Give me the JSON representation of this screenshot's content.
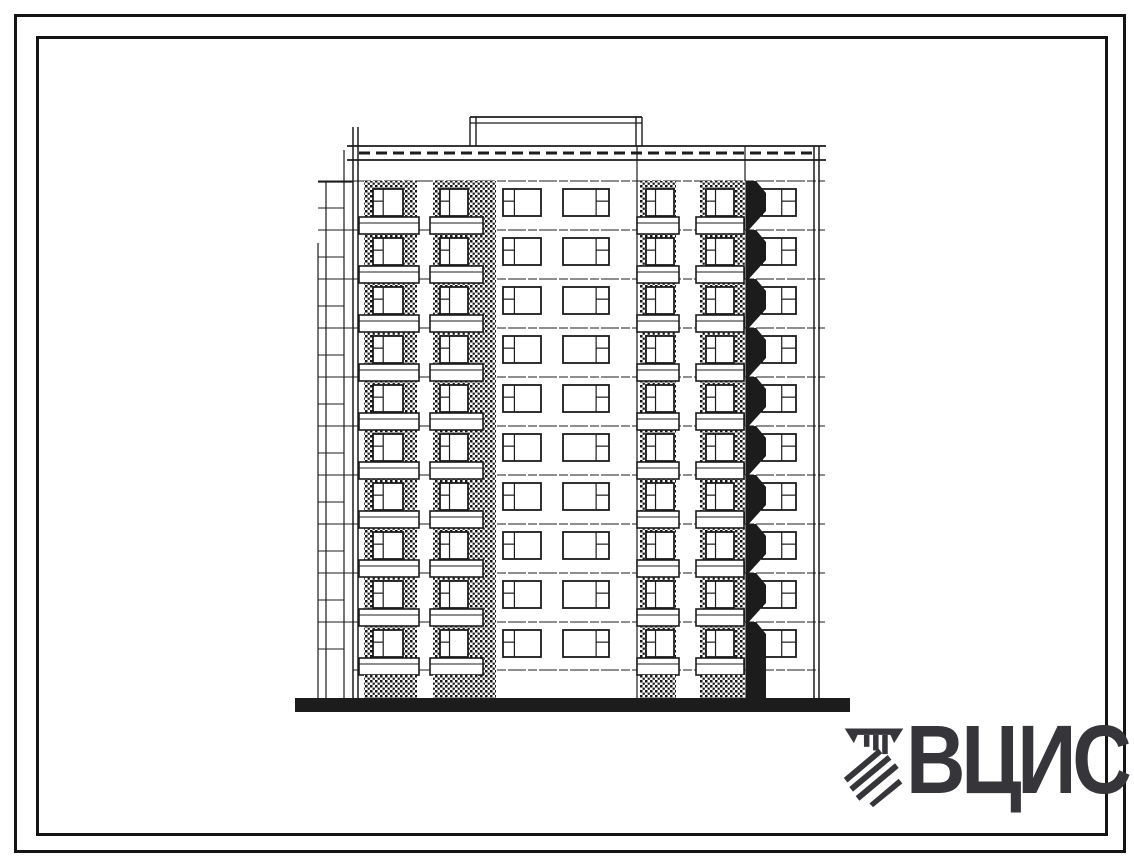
{
  "page": {
    "background": "#ffffff",
    "ink": "#1c1c1c"
  },
  "frame": {
    "outer_inset_px": 14,
    "inner_inset_px": 36,
    "stroke_px": 3,
    "color": "#151515"
  },
  "logo": {
    "text": "ВЦИС",
    "color": "#35353a",
    "emblem_icon": "diagonal-hatch-construction-emblem"
  },
  "elevation": {
    "type": "panel-apartment-building-facade-elevation",
    "storeys": 10,
    "floor_tops": [
      189,
      238,
      287,
      336,
      385,
      434,
      483,
      532,
      581,
      630
    ],
    "window_height": 27,
    "facade": {
      "left": 353,
      "left2": 358,
      "right": 814,
      "right2": 819,
      "parapet_left": 347,
      "parapet_right": 826,
      "parapet_top": 146,
      "parapet_bottom": 160,
      "parapet_dash_y": 153,
      "edge_top": 127,
      "bottom": 698,
      "lower_line_y": 670
    },
    "machine_room": {
      "x1": 470,
      "x2": 642,
      "top": 117,
      "bottom": 146
    },
    "flank": {
      "lines": [
        {
          "x": 318,
          "top": 243
        },
        {
          "x": 326,
          "top": 182
        },
        {
          "x": 344,
          "top": 150
        }
      ],
      "tick_right": 353,
      "tick_short_right": 344,
      "top_y": 182,
      "bottom": 698
    },
    "shaft": {
      "x": 478,
      "w": 18,
      "top": 181,
      "bottom": 698
    },
    "joints": [
      {
        "x": 637
      },
      {
        "x": 745
      }
    ],
    "hatch_bays": [
      {
        "x": 364,
        "w": 53,
        "win_x": 373,
        "win_w": 30
      },
      {
        "x": 433,
        "w": 45,
        "win_x": 440,
        "win_w": 28
      },
      {
        "x": 640,
        "w": 36,
        "win_x": 646,
        "win_w": 28
      },
      {
        "x": 700,
        "w": 45,
        "win_x": 706,
        "win_w": 28
      }
    ],
    "plain_windows": [
      {
        "x": 503,
        "w": 38,
        "mullion": 0.3,
        "transom": "left"
      },
      {
        "x": 563,
        "w": 46,
        "mullion": 0.72,
        "transom": "right"
      },
      {
        "x": 762,
        "w": 34,
        "mullion": 0.58,
        "transom": "right"
      }
    ],
    "balcony_bands": [
      {
        "x": 359,
        "w": 60
      },
      {
        "x": 430,
        "w": 53
      },
      {
        "x": 637,
        "w": 42
      },
      {
        "x": 696,
        "w": 48
      }
    ],
    "balcony_shadow": {
      "x1": 746,
      "x2": 766
    },
    "ground": {
      "x1": 295,
      "x2": 850,
      "y1": 698,
      "y2": 712
    }
  }
}
